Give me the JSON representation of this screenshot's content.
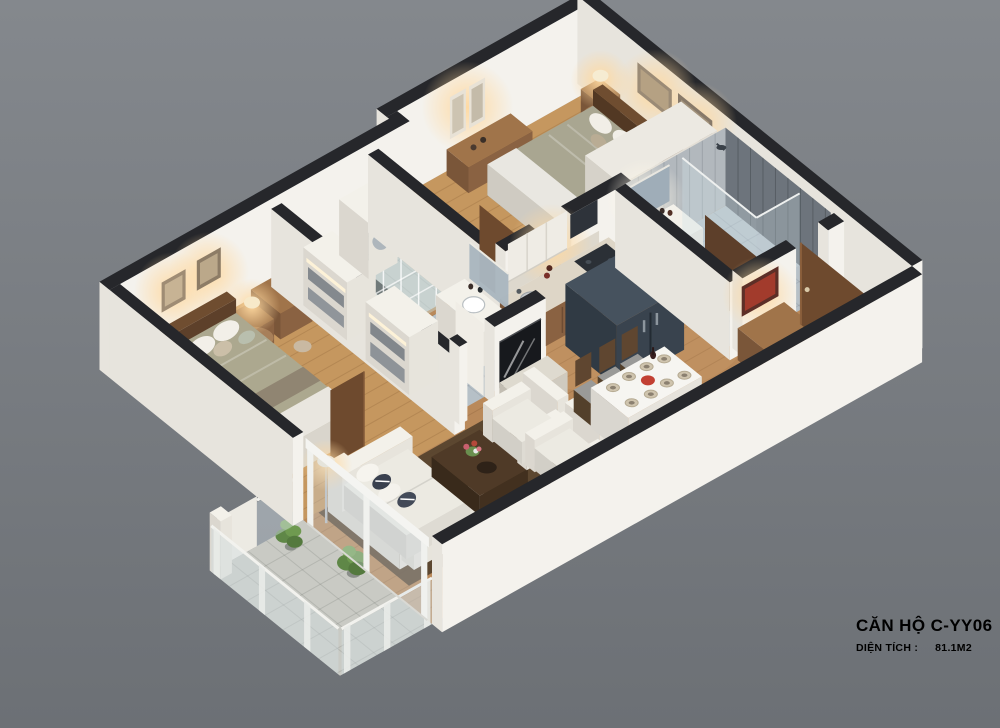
{
  "caption": {
    "title": "CĂN HỘ C-YY06",
    "area_label": "DIỆN TÍCH :",
    "area_value": "81.1M2"
  },
  "palette": {
    "background_top": "#84888d",
    "background_bottom": "#6c7075",
    "wall_cap": "#26272b",
    "wall_face": "#f4f2ed",
    "wall_face_shade": "#e7e4dd",
    "wood_floor": "#b9895a",
    "bedroom_floor": "#c5975f",
    "tile_floor": "#b6c0c7",
    "balcony_tile": "#c9cac4",
    "rug": "#55422d",
    "tall_unit": "#46525e",
    "wood_furniture": "#8a6242",
    "dark_wood": "#5f452e",
    "sofa_white": "#efede6",
    "bed_blanket": "#aca88f",
    "accent_red": "#c24033",
    "plant_green": "#679348",
    "lamp_glow": "#ffd9a0",
    "caption_text": "#3e4348"
  }
}
